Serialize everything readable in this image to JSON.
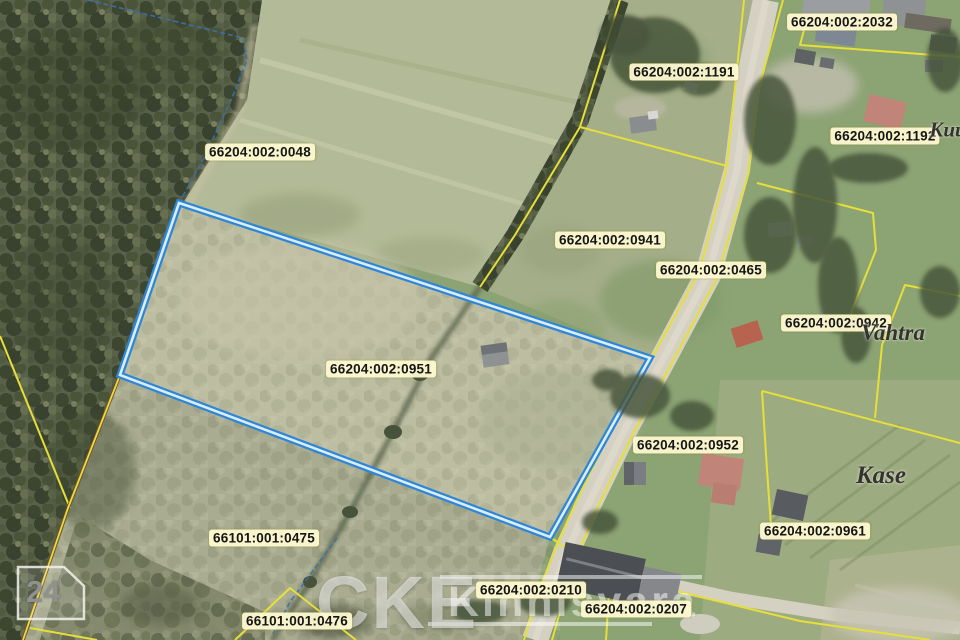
{
  "map": {
    "selected_parcel": "66204:002:0951",
    "parcel_labels": [
      {
        "text": "66204:002:2032",
        "x": 842,
        "y": 22
      },
      {
        "text": "66204:002:1191",
        "x": 684,
        "y": 72
      },
      {
        "text": "66204:002:1192",
        "x": 885,
        "y": 136
      },
      {
        "text": "66204:002:0048",
        "x": 260,
        "y": 152
      },
      {
        "text": "66204:002:0941",
        "x": 610,
        "y": 240
      },
      {
        "text": "66204:002:0465",
        "x": 711,
        "y": 270
      },
      {
        "text": "66204:002:0942",
        "x": 836,
        "y": 323
      },
      {
        "text": "66204:002:0951",
        "x": 381,
        "y": 369
      },
      {
        "text": "66204:002:0952",
        "x": 688,
        "y": 445
      },
      {
        "text": "66204:002:0961",
        "x": 815,
        "y": 531
      },
      {
        "text": "66101:001:0475",
        "x": 264,
        "y": 538
      },
      {
        "text": "66204:002:0210",
        "x": 531,
        "y": 590
      },
      {
        "text": "66204:002:0207",
        "x": 636,
        "y": 609
      },
      {
        "text": "66101:001:0476",
        "x": 297,
        "y": 621
      }
    ],
    "place_names": [
      {
        "text": "Kuu",
        "x": 948,
        "y": 130,
        "size": 21
      },
      {
        "text": "Vahtra",
        "x": 893,
        "y": 333,
        "size": 23
      },
      {
        "text": "Kase",
        "x": 881,
        "y": 476,
        "size": 25
      }
    ],
    "sheet_number": "24",
    "watermark": {
      "brand": "CKE",
      "word": "Kinnisvara"
    },
    "colors": {
      "boundary_yellow": "#e6df3a",
      "selected_blue": "#2e86d4",
      "selected_core": "#d9edfb",
      "label_bg": "#fdf9d0",
      "label_text": "#151515",
      "stream_blue": "#3a6fae"
    }
  }
}
